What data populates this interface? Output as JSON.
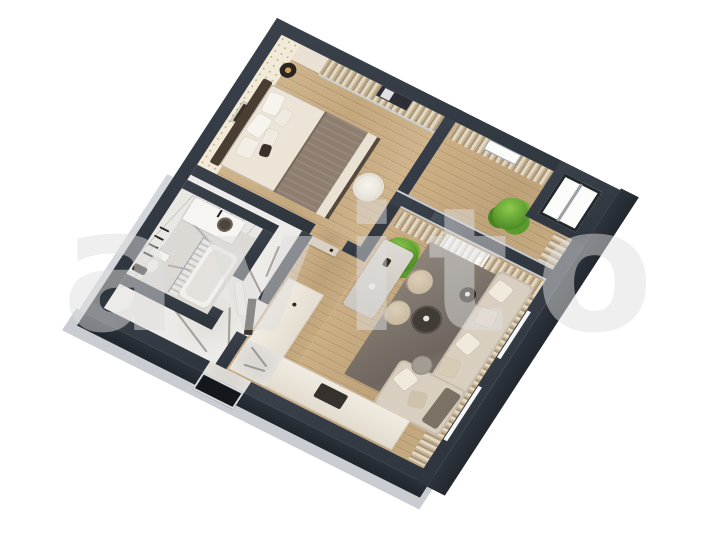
{
  "watermark": {
    "text": "avito"
  },
  "scene": {
    "type": "3d-floor-plan-render",
    "view": "isometric-top-down",
    "rooms": [
      {
        "name": "bedroom"
      },
      {
        "name": "balcony"
      },
      {
        "name": "living-room"
      },
      {
        "name": "kitchen"
      },
      {
        "name": "hallway"
      },
      {
        "name": "bathroom"
      }
    ],
    "colors": {
      "background": "#ffffff",
      "wall_top": "#353b44",
      "wall_side": "#262b31",
      "floor_slab": "#c9cdd1",
      "wood_floor": "#c9ae86",
      "marble_floor": "#edebe7",
      "sofa": "#d9cfc0",
      "rug": "#7d746c",
      "curtains": "#c7b393",
      "plants": "#5a9c2c",
      "bed_throw": "#8d7e6f"
    }
  }
}
